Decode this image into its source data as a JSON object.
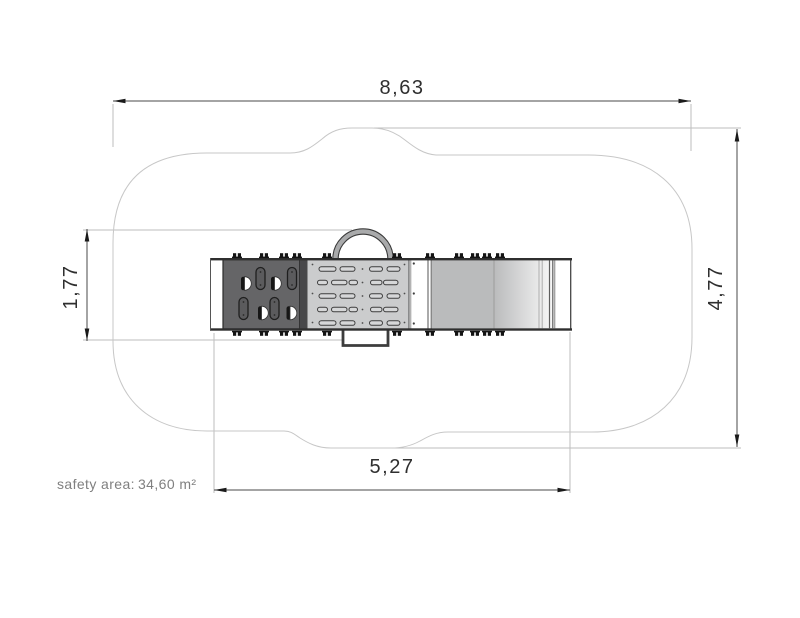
{
  "drawing": {
    "type": "playground-equipment-top-view-safety-area-plan",
    "dim_overall_width": "8,63",
    "dim_overall_height": "4,77",
    "dim_unit_depth": "1,77",
    "dim_unit_length": "5,27",
    "safety_area_label": "safety area:",
    "safety_area_value": "34,60 m²",
    "colors": {
      "background": "#ffffff",
      "safety_outline": "#c7c7c7",
      "dimension_line": "#4a4a4a",
      "extension_line": "#bdbdbd",
      "dimension_text": "#2f2f2f",
      "note_text": "#7f7f7f",
      "climbing_panel": "#656567",
      "crawl_panel": "#cbcccd",
      "slide_gray": "#babbbc",
      "rail_dark": "#2f2f2f"
    }
  }
}
